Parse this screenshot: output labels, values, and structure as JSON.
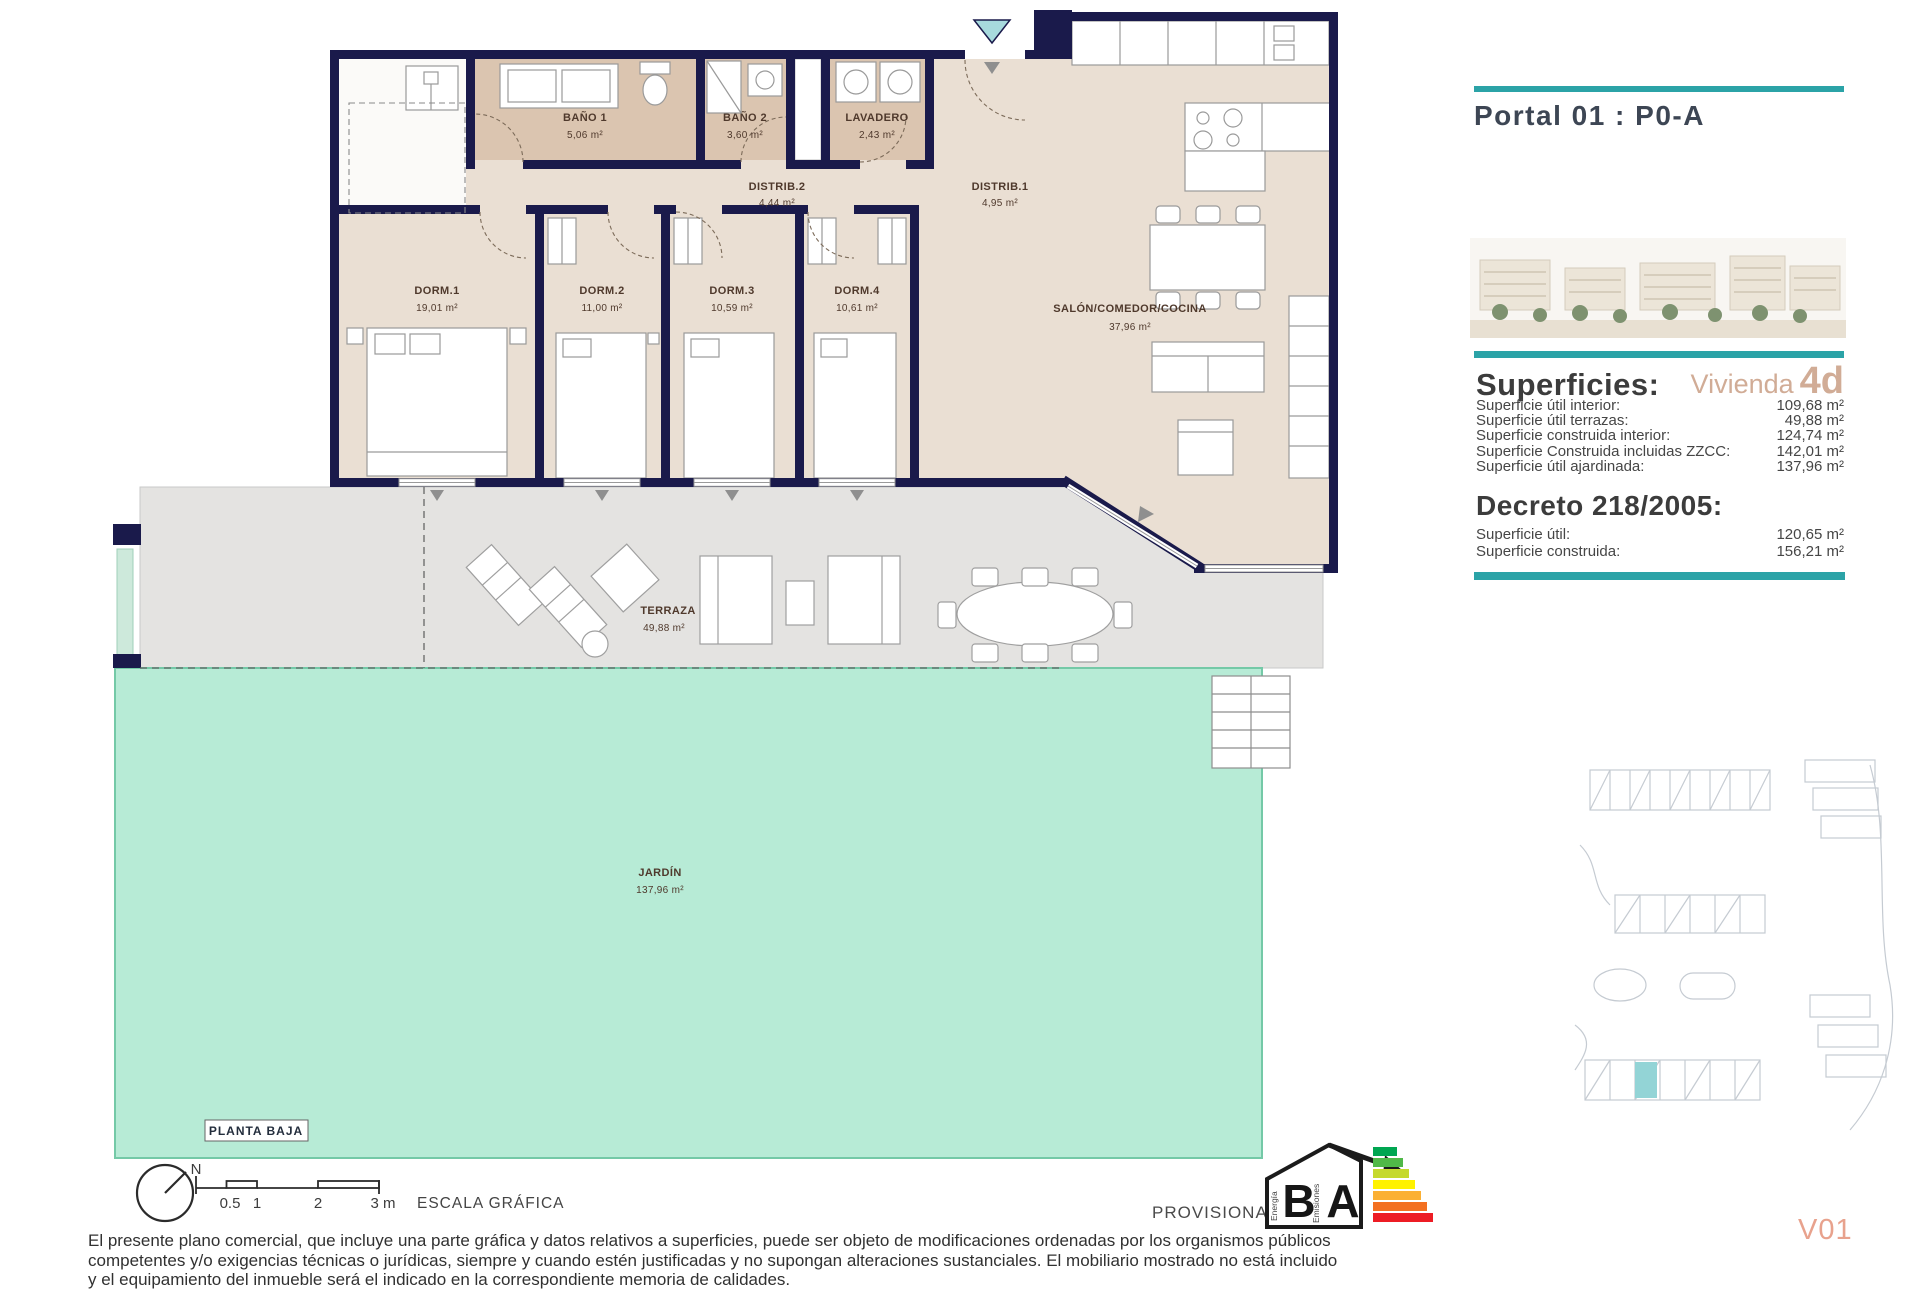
{
  "plan": {
    "bano1": {
      "label": "BAÑO 1",
      "area": "5,06 m²"
    },
    "bano2": {
      "label": "BAÑO 2",
      "area": "3,60 m²"
    },
    "lavadero": {
      "label": "LAVADERO",
      "area": "2,43 m²"
    },
    "distrib2": {
      "label": "DISTRIB.2",
      "area": "4,44 m²"
    },
    "distrib1": {
      "label": "DISTRIB.1",
      "area": "4,95 m²"
    },
    "dorm1": {
      "label": "DORM.1",
      "area": "19,01 m²"
    },
    "dorm2": {
      "label": "DORM.2",
      "area": "11,00 m²"
    },
    "dorm3": {
      "label": "DORM.3",
      "area": "10,59 m²"
    },
    "dorm4": {
      "label": "DORM.4",
      "area": "10,61 m²"
    },
    "salon": {
      "label": "SALÓN/COMEDOR/COCINA",
      "area": "37,96 m²"
    },
    "terraza": {
      "label": "TERRAZA",
      "area": "49,88 m²"
    },
    "jardin": {
      "label": "JARDÍN",
      "area": "137,96 m²"
    },
    "floor_label": "PLANTA BAJA"
  },
  "sidebar": {
    "portal_title": "Portal 01 : P0-A",
    "superficies": {
      "heading": "Superficies:",
      "vivienda_label": "Vivienda",
      "vivienda_code": "4d",
      "rows": [
        {
          "label": "Superficie útil interior:",
          "value": "109,68 m²"
        },
        {
          "label": "Superficie útil terrazas:",
          "value": "49,88 m²"
        },
        {
          "label": "Superficie construida interior:",
          "value": "124,74 m²"
        },
        {
          "label": "Superficie Construida incluidas ZZCC:",
          "value": "142,01 m²"
        },
        {
          "label": "Superficie útil ajardinada:",
          "value": "137,96 m²"
        }
      ]
    },
    "decreto": {
      "heading": "Decreto 218/2005:",
      "rows": [
        {
          "label": "Superficie útil:",
          "value": "120,65 m²"
        },
        {
          "label": "Superficie construida:",
          "value": "156,21 m²"
        }
      ]
    },
    "version": "V01"
  },
  "footer": {
    "scale": {
      "north": "N",
      "ticks": [
        "0.5",
        "1",
        "2",
        "3 m"
      ],
      "label": "ESCALA GRÁFICA"
    },
    "provisional": "PROVISIONAL",
    "energy": {
      "letter_b": "B",
      "letter_a": "A",
      "energia": "Energía",
      "emisiones": "Emisiones"
    },
    "disclaimer_lines": [
      "El presente plano comercial, que incluye una parte gráfica y datos relativos a superficies, puede ser objeto de modificaciones ordenadas por los organismos públicos",
      "competentes y/o exigencias técnicas o jurídicas, siempre y cuando estén justificadas y no supongan alteraciones sustanciales. El mobiliario mostrado no está incluido",
      "y el equipamiento del inmueble será el indicado en la correspondiente memoria de calidades."
    ]
  },
  "colors": {
    "accent_teal": "#2ba3a7",
    "wall_navy": "#1a1a4b",
    "floor_beige": "#eadfd3",
    "bath_tan": "#dbc5b0",
    "terrace_gray": "#e4e3e1",
    "garden_mint": "#b7ebd6",
    "vivienda_tan": "#d1ac96",
    "version_coral": "#e8a28d"
  }
}
